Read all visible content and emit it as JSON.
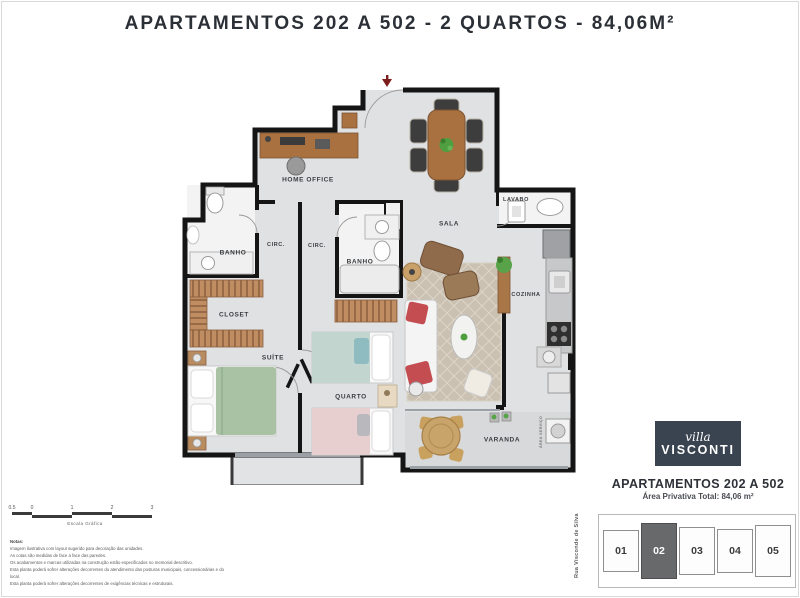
{
  "title": "APARTAMENTOS 202 A 502 - 2 QUARTOS - 84,06M²",
  "plan": {
    "rooms": [
      {
        "id": "home-office",
        "label": "HOME OFFICE"
      },
      {
        "id": "banho-1",
        "label": "BANHO"
      },
      {
        "id": "circ-1",
        "label": "CIRC."
      },
      {
        "id": "circ-2",
        "label": "CIRC."
      },
      {
        "id": "banho-2",
        "label": "BANHO"
      },
      {
        "id": "sala",
        "label": "SALA"
      },
      {
        "id": "lavabo",
        "label": "LAVABO"
      },
      {
        "id": "cozinha",
        "label": "COZINHA"
      },
      {
        "id": "closet",
        "label": "CLOSET"
      },
      {
        "id": "suite",
        "label": "SUÍTE"
      },
      {
        "id": "quarto",
        "label": "QUARTO"
      },
      {
        "id": "varanda",
        "label": "VARANDA"
      },
      {
        "id": "area-servico",
        "label": "ÁREA SERVIÇO"
      }
    ],
    "entry_arrow_color": "#7c1d1d"
  },
  "scale_bar": {
    "ticks": [
      "0.5",
      "0",
      "1",
      "2",
      "3"
    ],
    "caption": "Escala Gráfica"
  },
  "notes": {
    "heading": "Notas:",
    "lines": [
      "Imagem ilustrativa com layout sugerido para decoração das unidades.",
      "As cotas são medidas de face a face das paredes.",
      "Os acabamentos e marcas utilizadas na construção estão especificados no memorial descritivo.",
      "Esta planta poderá sofrer alterações decorrentes do atendimento das posturas municipais, concessionárias e do local.",
      "Esta planta poderá sofrer alterações decorrentes de exigências técnicas e estruturais."
    ]
  },
  "branding": {
    "logo_line1": "villa",
    "logo_line2": "VISCONTI",
    "logo_bg": "#3a4450"
  },
  "unit_info": {
    "title": "APARTAMENTOS 202 A 502",
    "subtitle": "Área Privativa Total: 84,06 m²"
  },
  "key_plan": {
    "street": "Rua Visconde de Silva",
    "units": [
      {
        "label": "01",
        "highlighted": false
      },
      {
        "label": "02",
        "highlighted": true
      },
      {
        "label": "03",
        "highlighted": false
      },
      {
        "label": "04",
        "highlighted": false
      },
      {
        "label": "05",
        "highlighted": false
      }
    ],
    "highlight_color": "#68696b"
  },
  "colors": {
    "wall": "#151515",
    "floor": "#e0e1e3",
    "wood": "#a9713f",
    "suite_bed": "#a9c2a4",
    "rug": "#cbc1b2",
    "accent_red": "#c44d52"
  }
}
